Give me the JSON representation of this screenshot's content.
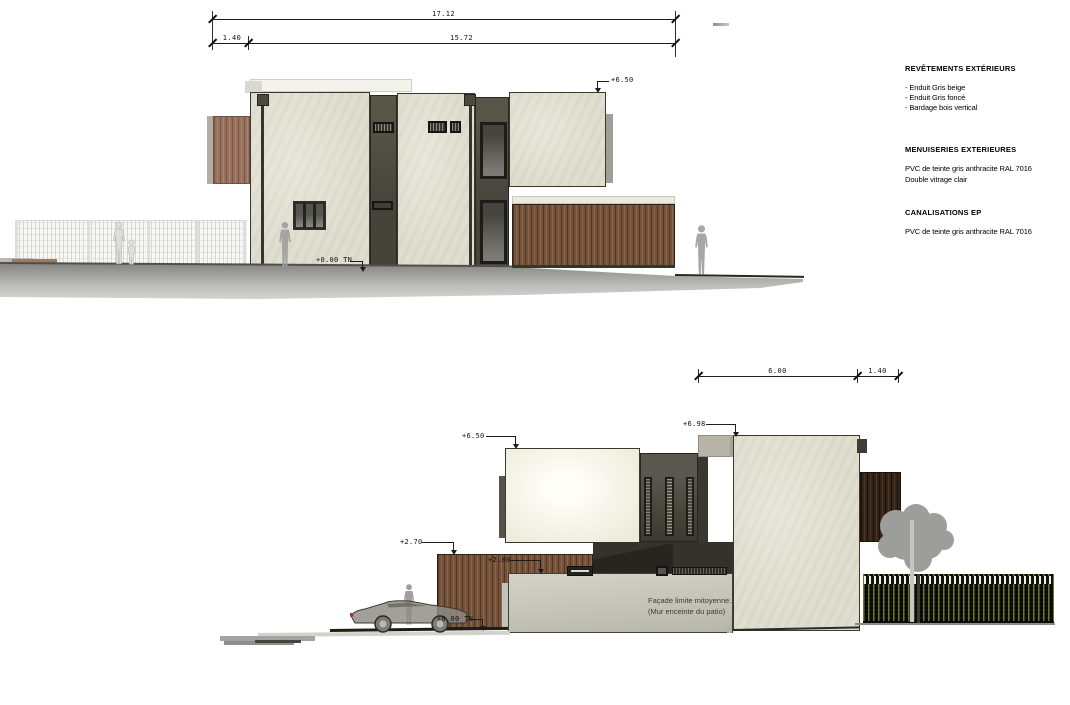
{
  "elevation_top": {
    "dims": {
      "total": "17.12",
      "seg_left": "1.40",
      "seg_right": "15.72"
    },
    "levels": {
      "roof": "+6.50",
      "ground": "+0.00 TN"
    }
  },
  "elevation_bottom": {
    "dims": {
      "width": "6.00",
      "setback": "1.40"
    },
    "levels": {
      "roof_left": "+6.50",
      "roof_top": "+6.98",
      "fence": "+2.70",
      "wall": "+2.00",
      "ground": "+0.00 TN"
    },
    "notes": {
      "line1": "Façade limite mitoyenne.",
      "line2": "(Mur enceinte du patio)"
    }
  },
  "legend": {
    "sections": [
      {
        "title": "REVÊTEMENTS EXTÉRIEURS",
        "items": [
          "- Enduit Gris beige",
          "- Enduit Gris foncé",
          "- Bardage bois vertical"
        ]
      },
      {
        "title": "MENUISERIES EXTERIEURES",
        "items": [
          "PVC de teinte gris anthracite RAL 7016",
          "Double vitrage clair"
        ]
      },
      {
        "title": "CANALISATIONS EP",
        "items": [
          "PVC de teinte gris anthracite RAL 7016"
        ]
      }
    ]
  },
  "colors": {
    "render_beige": "#dfdecf",
    "render_dark_cladding": "#4b4a42",
    "wood_cladding": "#75523a",
    "dark_wood": "#342418",
    "patio_wall": "#c6c5b9",
    "ground": "#a9a9a7",
    "annotation": "#1c1c1c"
  }
}
